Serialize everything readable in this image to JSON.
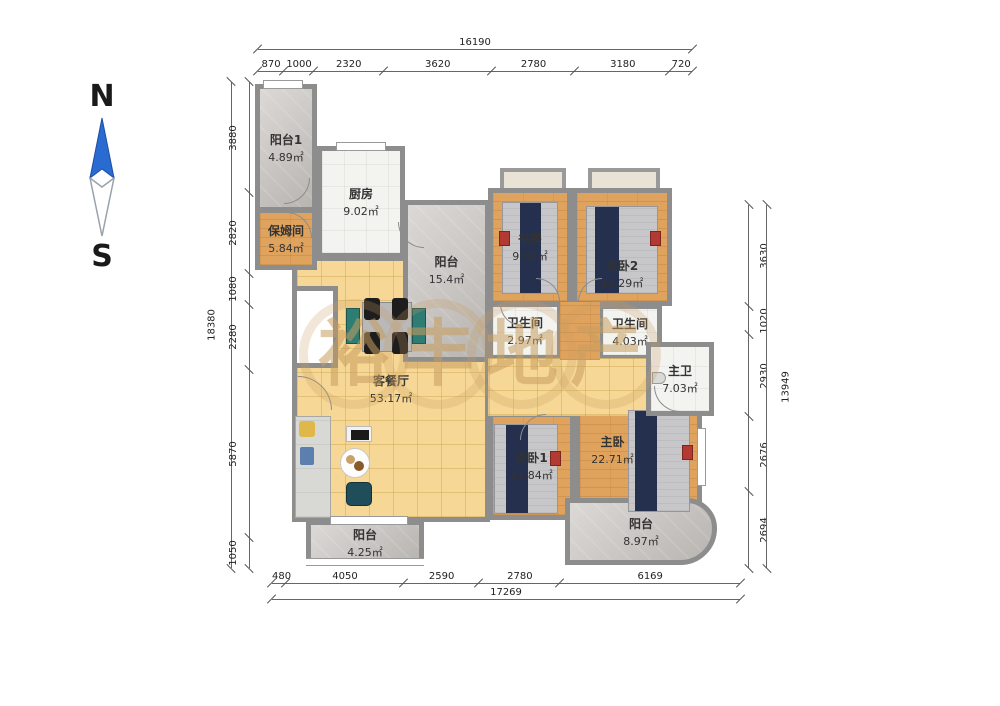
{
  "compass": {
    "north": "N",
    "south": "S",
    "needle_color": "#2a6bd2"
  },
  "watermark": {
    "chars": [
      "裕",
      "丰",
      "地",
      "产"
    ],
    "color": "#c69d5f"
  },
  "rooms": [
    {
      "id": "balcony-1",
      "name": "阳台1",
      "area": "4.89㎡"
    },
    {
      "id": "nanny-room",
      "name": "保姆间",
      "area": "5.84㎡"
    },
    {
      "id": "kitchen",
      "name": "厨房",
      "area": "9.02㎡"
    },
    {
      "id": "balcony-center",
      "name": "阳台",
      "area": "15.4㎡"
    },
    {
      "id": "study",
      "name": "书房",
      "area": "9.68㎡"
    },
    {
      "id": "bedroom-2",
      "name": "次卧2",
      "area": "13.29㎡"
    },
    {
      "id": "bathroom-1",
      "name": "卫生间",
      "area": "2.97㎡"
    },
    {
      "id": "bathroom-2",
      "name": "卫生间",
      "area": "4.03㎡"
    },
    {
      "id": "master-bathroom",
      "name": "主卫",
      "area": "7.03㎡"
    },
    {
      "id": "living-dining",
      "name": "客餐厅",
      "area": "53.17㎡"
    },
    {
      "id": "bedroom-1",
      "name": "次卧1",
      "area": "11.84㎡"
    },
    {
      "id": "master-bedroom",
      "name": "主卧",
      "area": "22.71㎡"
    },
    {
      "id": "balcony-bottom-left",
      "name": "阳台",
      "area": "4.25㎡"
    },
    {
      "id": "balcony-bottom-right",
      "name": "阳台",
      "area": "8.97㎡"
    }
  ],
  "dimensions": {
    "top": {
      "total": "16190",
      "segments": [
        "870",
        "1000",
        "2320",
        "3620",
        "2780",
        "3180",
        "720"
      ]
    },
    "left": {
      "total": "18380",
      "segments": [
        "3880",
        "2820",
        "1080",
        "2280",
        "5870",
        "1050"
      ]
    },
    "right": {
      "total": "13949",
      "segments": [
        "3630",
        "1020",
        "2930",
        "2676",
        "2694"
      ]
    },
    "bottom": {
      "total": "17269",
      "segments": [
        "480",
        "4050",
        "2590",
        "2780",
        "6169"
      ]
    }
  }
}
